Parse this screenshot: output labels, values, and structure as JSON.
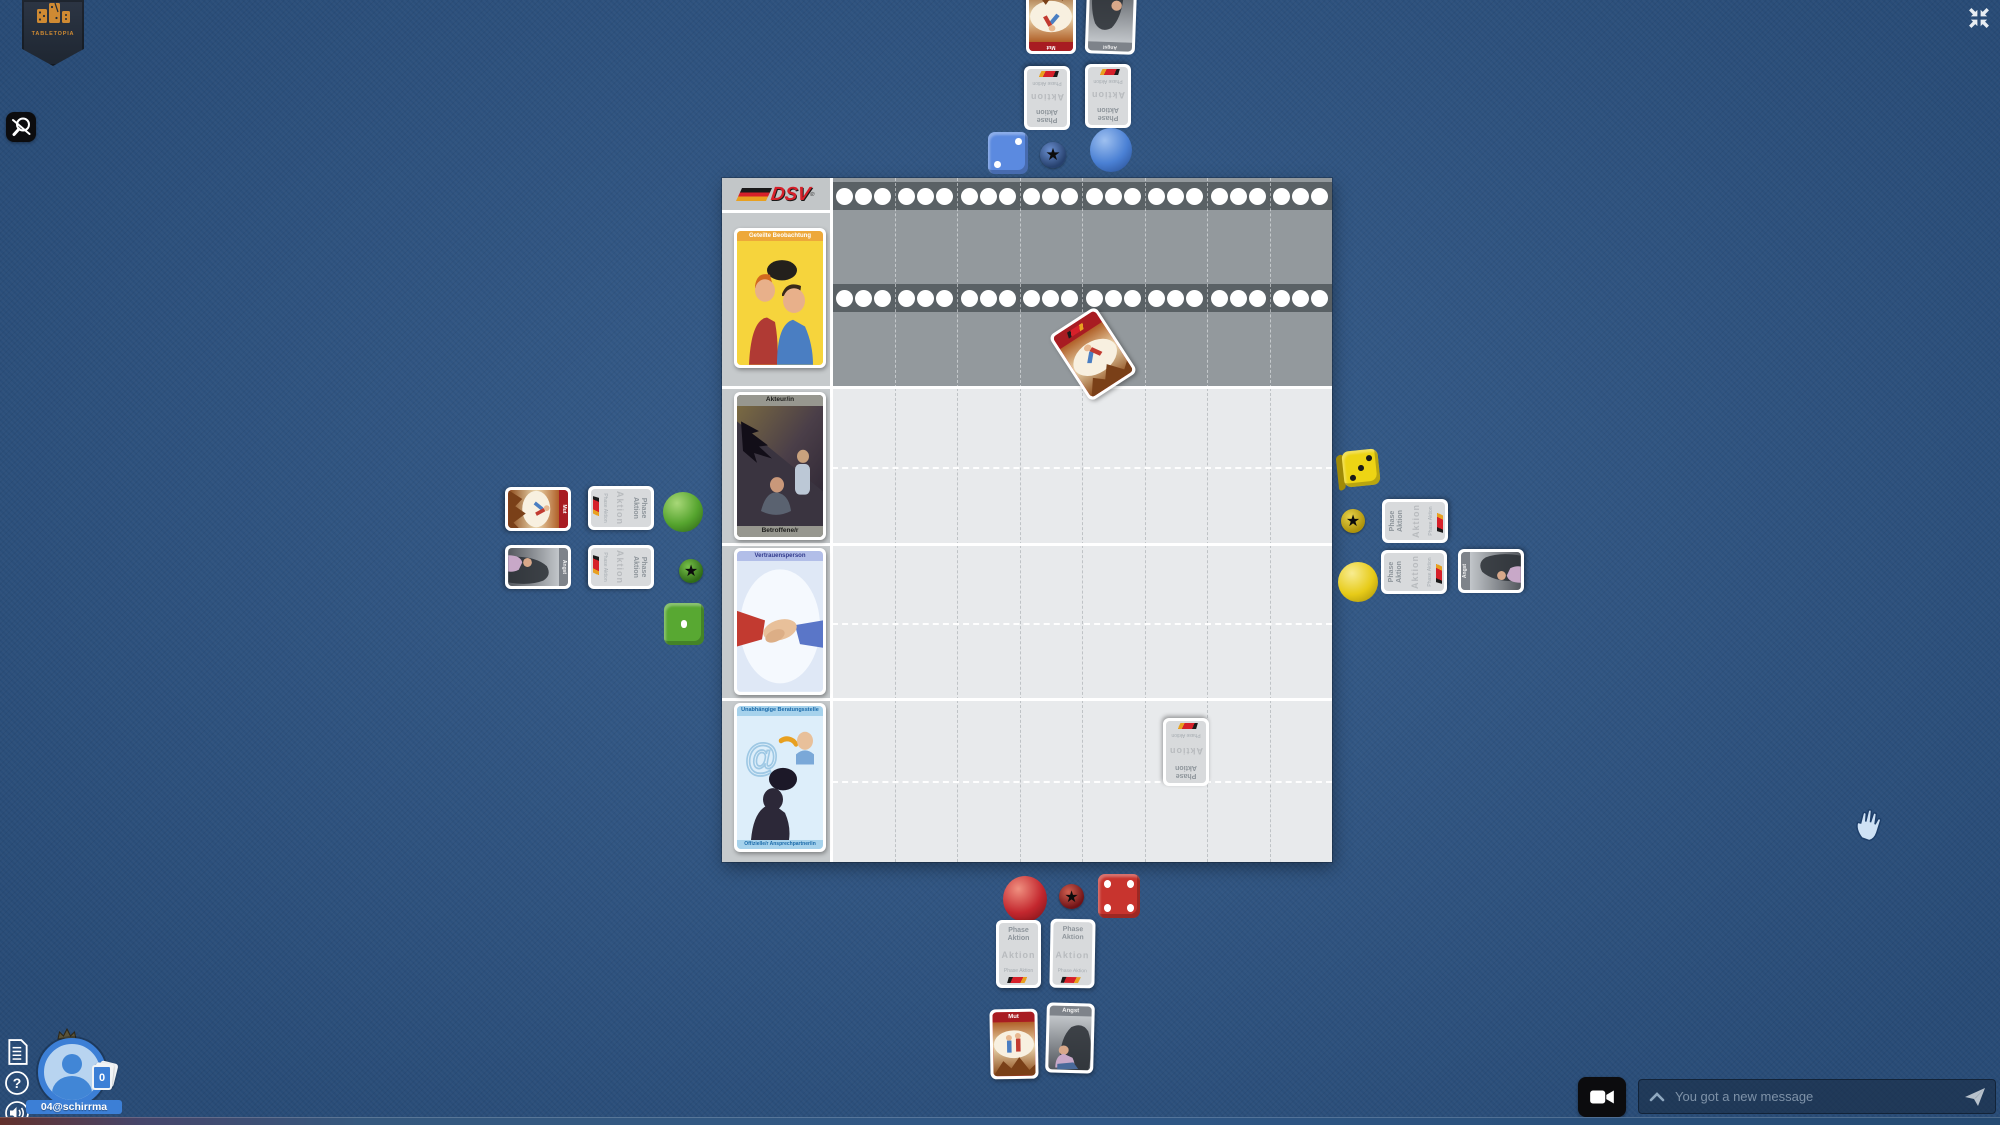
{
  "brand": {
    "name": "TABLETOPIA"
  },
  "hud": {
    "chat_placeholder": "You got a new message",
    "player": {
      "username": "04@schirrma",
      "hand_count": "0"
    }
  },
  "icons": {
    "star": "★",
    "help": "?"
  },
  "board": {
    "logo_text": "DSV",
    "logo_mark": "®",
    "track": {
      "rows": 2,
      "groups": 8,
      "circles_per_group": 3
    },
    "cards": {
      "observation_title": "Geteilte Beobachtung",
      "actor_top": "Akteur/in",
      "actor_bottom": "Betroffene/r",
      "trust_title": "Vertrauensperson",
      "counsel_top": "Unabhängige Beratungsstelle",
      "counsel_bottom": "Offizielle/r Ansprechpartner/in"
    }
  },
  "cards": {
    "back_title": "Phase Aktion",
    "back_watermark": "Aktion",
    "mut_title": "Mut",
    "angst_title": "Angst",
    "at_glyph": "@"
  },
  "dice": {
    "blue": 2,
    "green": 1,
    "yellow": 3,
    "red": 4
  },
  "colors": {
    "table_blue": "#2d5586",
    "dsv_red": "#d6202a",
    "player_blue": "#4a80d4",
    "player_green": "#55a42e",
    "player_yellow": "#e7cb18",
    "player_red": "#c3272e",
    "board_dark": "#93999d",
    "board_light": "#e8eaec"
  }
}
